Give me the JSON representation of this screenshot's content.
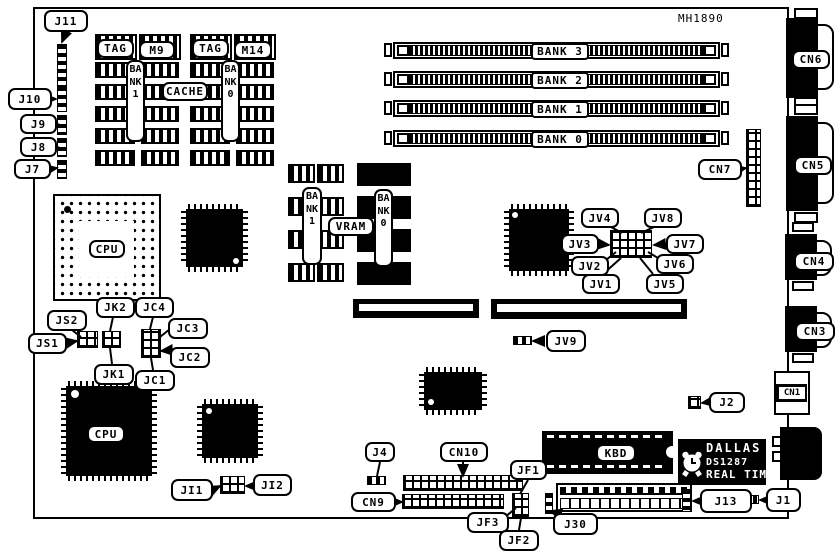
{
  "part_number": "MH1890",
  "memory": {
    "banks": [
      "BANK 3",
      "BANK 2",
      "BANK 1",
      "BANK 0"
    ]
  },
  "cache": {
    "title": "CACHE",
    "tag_left": "TAG",
    "module_left": "M9",
    "tag_right": "TAG",
    "module_right": "M14",
    "bank_left": "BANK1",
    "bank_right": "BANK0"
  },
  "video": {
    "title": "VRAM",
    "bank_left": "BANK1",
    "bank_right": "BANK0"
  },
  "processors": {
    "cpu_socket": "CPU",
    "cpu_chip": "CPU"
  },
  "keyboard_controller": "KBD",
  "rtc": {
    "brand": "DALLAS",
    "model": "DS1287",
    "type": "REAL TIME"
  },
  "connectors": {
    "cn1": "CN1",
    "cn3": "CN3",
    "cn4": "CN4",
    "cn5": "CN5",
    "cn6": "CN6",
    "cn7": "CN7",
    "cn9": "CN9",
    "cn10": "CN10"
  },
  "jumpers": {
    "j1": "J1",
    "j2": "J2",
    "j4": "J4",
    "j7": "J7",
    "j8": "J8",
    "j9": "J9",
    "j10": "J10",
    "j11": "J11",
    "j13": "J13",
    "j30": "J30",
    "jv1": "JV1",
    "jv2": "JV2",
    "jv3": "JV3",
    "jv4": "JV4",
    "jv5": "JV5",
    "jv6": "JV6",
    "jv7": "JV7",
    "jv8": "JV8",
    "jv9": "JV9",
    "js1": "JS1",
    "js2": "JS2",
    "jk1": "JK1",
    "jk2": "JK2",
    "jc1": "JC1",
    "jc2": "JC2",
    "jc3": "JC3",
    "jc4": "JC4",
    "jf1": "JF1",
    "jf2": "JF2",
    "jf3": "JF3",
    "ji1": "JI1",
    "ji2": "JI2"
  }
}
